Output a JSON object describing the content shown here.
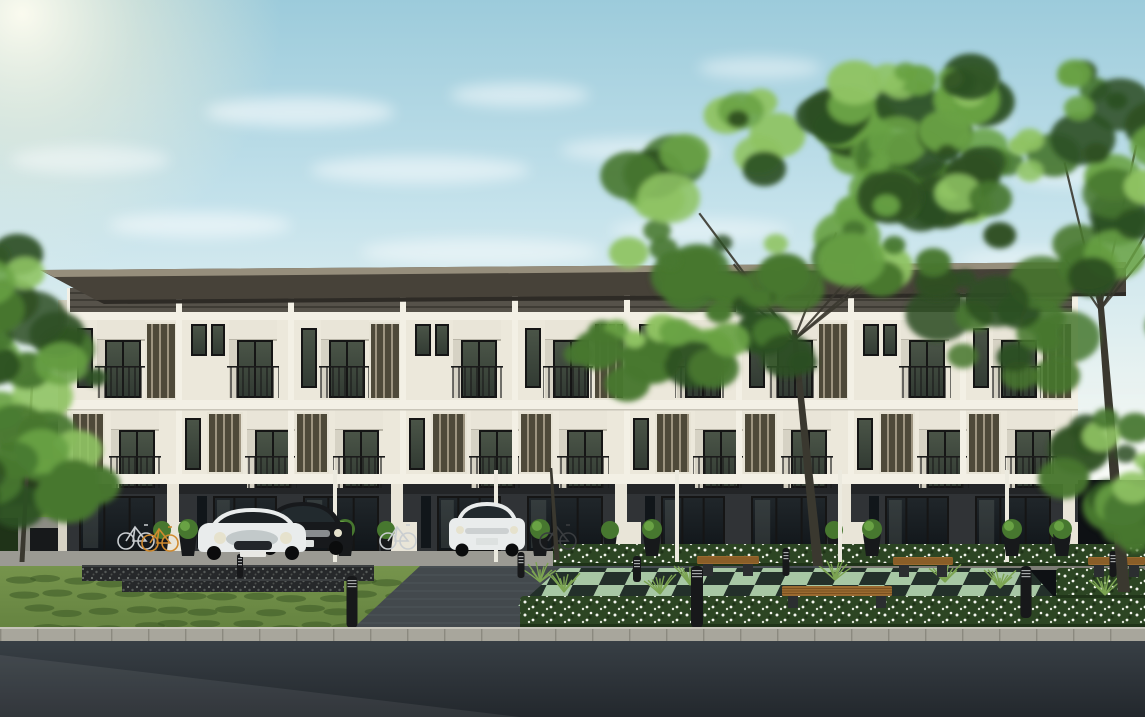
{
  "description": "Architectural rendering of a modern three-storey townhouse row with cream facades, dark vertical louver panels, black-framed balcony glazing, a dark recessed ground floor with parked cars, landscaped front garden with white flower hedges, wooden benches, bollard lights, large green trees and an asphalt road in the foreground under a pale blue sky with a soft sun glow at top left.",
  "palette": {
    "sky_top": "#9ccbdb",
    "sky_mid": "#c6e3ec",
    "sky_low": "#e7f2f1",
    "horizon_haze": "#f2f6ef",
    "sun_core": "#fffdf0",
    "sun_glow": "#f8f3da",
    "cloud": "#ffffff",
    "roof_top": "#968e7c",
    "roof_fascia": "#474239",
    "roof_shadow": "#2e2b26",
    "siding": "#56524a",
    "siding_line": "#3f3c35",
    "mullion": "#f3f0e5",
    "facade": "#ece8db",
    "facade_shade": "#d6d2c4",
    "louver_slat": "#4e4939",
    "louver_gap": "#9d9480",
    "louver_frame": "#e7e3d5",
    "frame": "#151515",
    "glass_top": "#4a5447",
    "glass_bot": "#323b33",
    "glass_dark": "#20262a",
    "glass_dark2": "#11161a",
    "glass_hi": "#9aa89b",
    "rail": "#1b1b1b",
    "ground": "#303336",
    "ground_shadow": "#232527",
    "fin": "#e9e5d8",
    "pavement": "#9b9a93",
    "pavement_dark": "#7e7d76",
    "gabion": "#26282a",
    "gabion_dot": "#6d716f",
    "lawn": "#5f7d3c",
    "lawn_dark": "#3c5926",
    "lawn_light": "#76944c",
    "hedge": "#2c4523",
    "hedge_dark": "#1f3318",
    "flower": "#f3f5ee",
    "grass_spike": "#7ca452",
    "checker_light": "#a7c7a4",
    "checker_dark": "#23302a",
    "driveway": "#43494d",
    "driveway_line": "#51585c",
    "curb": "#a8a69c",
    "curb_line": "#8b897f",
    "road": "#383f45",
    "road_dark": "#23282d",
    "wood": "#9a6a30",
    "wood_dark": "#6f4a1d",
    "bench_base": "#2b2e30",
    "bollard": "#17181a",
    "bollard_ring": "#c9cdcd",
    "pole": "#eceadf",
    "foliage_dark": "#2d4f23",
    "foliage_mid": "#47772f",
    "foliage_light": "#69a244",
    "foliage_hi": "#8fc363",
    "trunk": "#3a382f",
    "car_white": "#e9ecec",
    "car_white_shade": "#c2c9ca",
    "car_black": "#17191c",
    "car_glass": "#222a2e",
    "chrome": "#b9bec0",
    "headlight": "#e6e2cd",
    "bike_silver": "#c9cdd0",
    "bike_orange": "#d08a2e",
    "bike_dark": "#3a3d40",
    "wall_gray": "#8d8d85",
    "bin_dark": "#17191b",
    "distant_lawn": "#7ea24e"
  },
  "scene": {
    "sun": {
      "x": 22,
      "y": 14,
      "r": 260
    },
    "clouds": [
      {
        "x": 300,
        "y": 112,
        "rx": 95,
        "ry": 15,
        "o": 0.55
      },
      {
        "x": 520,
        "y": 95,
        "rx": 70,
        "ry": 12,
        "o": 0.5
      },
      {
        "x": 760,
        "y": 68,
        "rx": 62,
        "ry": 11,
        "o": 0.45
      },
      {
        "x": 930,
        "y": 120,
        "rx": 82,
        "ry": 13,
        "o": 0.4
      },
      {
        "x": 1080,
        "y": 175,
        "rx": 70,
        "ry": 12,
        "o": 0.45
      },
      {
        "x": 420,
        "y": 170,
        "rx": 110,
        "ry": 14,
        "o": 0.5
      },
      {
        "x": 640,
        "y": 150,
        "rx": 80,
        "ry": 12,
        "o": 0.45
      },
      {
        "x": 200,
        "y": 225,
        "rx": 92,
        "ry": 13,
        "o": 0.5
      },
      {
        "x": 480,
        "y": 252,
        "rx": 120,
        "ry": 14,
        "o": 0.45
      },
      {
        "x": 700,
        "y": 230,
        "rx": 90,
        "ry": 12,
        "o": 0.4
      },
      {
        "x": 320,
        "y": 302,
        "rx": 130,
        "ry": 15,
        "o": 0.5
      },
      {
        "x": 560,
        "y": 332,
        "rx": 150,
        "ry": 16,
        "o": 0.45
      },
      {
        "x": 820,
        "y": 300,
        "rx": 110,
        "ry": 13,
        "o": 0.35
      },
      {
        "x": 180,
        "y": 382,
        "rx": 140,
        "ry": 16,
        "o": 0.4
      },
      {
        "x": 480,
        "y": 420,
        "rx": 170,
        "ry": 18,
        "o": 0.4
      },
      {
        "x": 900,
        "y": 400,
        "rx": 120,
        "ry": 14,
        "o": 0.3
      },
      {
        "x": 1050,
        "y": 260,
        "rx": 90,
        "ry": 12,
        "o": 0.35
      },
      {
        "x": 90,
        "y": 160,
        "rx": 80,
        "ry": 14,
        "o": 0.45
      }
    ],
    "building": {
      "left": 67,
      "right": 1078,
      "unit_w": 224,
      "units": 5,
      "roof": {
        "x1": 40,
        "x2": 1126,
        "top": 262
      },
      "clerestory_top": 288,
      "beam1": 312,
      "f3_top": 320,
      "beam2": 400,
      "f2_top": 410,
      "beam3": 474,
      "ground_top": 484,
      "base": 556
    },
    "trunks": [
      {
        "x1": 22,
        "y1": 562,
        "x2": 32,
        "y2": 386,
        "w": 5
      },
      {
        "x1": 557,
        "y1": 560,
        "x2": 551,
        "y2": 468,
        "w": 5
      },
      {
        "x1": 818,
        "y1": 566,
        "x2": 794,
        "y2": 330,
        "w": 10
      },
      {
        "x1": 1124,
        "y1": 592,
        "x2": 1100,
        "y2": 296,
        "w": 12
      }
    ],
    "foliage_clusters": [
      {
        "cx": 25,
        "cy": 430,
        "rx": 82,
        "ry": 118,
        "n": 32,
        "seed": 11
      },
      {
        "cx": 10,
        "cy": 295,
        "rx": 46,
        "ry": 52,
        "n": 10,
        "seed": 5
      },
      {
        "cx": 800,
        "cy": 235,
        "rx": 190,
        "ry": 148,
        "n": 58,
        "seed": 7
      },
      {
        "cx": 660,
        "cy": 330,
        "rx": 92,
        "ry": 80,
        "n": 20,
        "seed": 19
      },
      {
        "cx": 930,
        "cy": 140,
        "rx": 120,
        "ry": 82,
        "n": 26,
        "seed": 9
      },
      {
        "cx": 1040,
        "cy": 220,
        "rx": 172,
        "ry": 182,
        "n": 64,
        "seed": 23
      },
      {
        "cx": 1118,
        "cy": 485,
        "rx": 62,
        "ry": 75,
        "n": 20,
        "seed": 15
      }
    ],
    "cars": [
      {
        "type": "sedan-black",
        "x": 254,
        "y": 500
      },
      {
        "type": "mini-white",
        "x": 198,
        "y": 505
      },
      {
        "type": "suv-white",
        "x": 449,
        "y": 498
      }
    ],
    "bikes": [
      {
        "x": 126,
        "y": 525,
        "c": "bike_silver"
      },
      {
        "x": 150,
        "y": 527,
        "c": "bike_orange"
      },
      {
        "x": 388,
        "y": 525,
        "c": "bike_silver"
      },
      {
        "x": 548,
        "y": 525,
        "c": "bike_dark"
      }
    ],
    "bollards": [
      {
        "x": 352,
        "y": 576,
        "h": 52,
        "w": 11
      },
      {
        "x": 697,
        "y": 566,
        "h": 62,
        "w": 12
      },
      {
        "x": 1026,
        "y": 566,
        "h": 52,
        "w": 11
      },
      {
        "x": 637,
        "y": 556,
        "h": 26,
        "w": 8
      },
      {
        "x": 521,
        "y": 552,
        "h": 26,
        "w": 7
      },
      {
        "x": 786,
        "y": 548,
        "h": 28,
        "w": 7
      },
      {
        "x": 240,
        "y": 554,
        "h": 24,
        "w": 6
      },
      {
        "x": 1113,
        "y": 551,
        "h": 26,
        "w": 7
      }
    ],
    "benches": [
      {
        "x": 697,
        "y": 556,
        "w": 62,
        "h": 8
      },
      {
        "x": 893,
        "y": 557,
        "w": 60,
        "h": 8
      },
      {
        "x": 1088,
        "y": 557,
        "w": 57,
        "h": 8
      },
      {
        "x": 782,
        "y": 586,
        "w": 110,
        "h": 10
      }
    ],
    "poles": [
      333,
      494,
      675,
      838,
      1005
    ],
    "planters": [
      {
        "x": 188,
        "y": 548
      },
      {
        "x": 345,
        "y": 548
      },
      {
        "x": 540,
        "y": 548
      },
      {
        "x": 652,
        "y": 548
      },
      {
        "x": 872,
        "y": 548
      },
      {
        "x": 1012,
        "y": 548
      },
      {
        "x": 1062,
        "y": 548
      }
    ],
    "flower_hedges": [
      {
        "x": 553,
        "y": 544,
        "w": 592,
        "h": 22
      },
      {
        "x": 520,
        "y": 596,
        "w": 625,
        "h": 31
      },
      {
        "x": 1056,
        "y": 568,
        "w": 89,
        "h": 30
      }
    ],
    "grass_clusters": [
      {
        "x": 540,
        "y": 574
      },
      {
        "x": 564,
        "y": 584
      },
      {
        "x": 690,
        "y": 577
      },
      {
        "x": 945,
        "y": 574
      },
      {
        "x": 1000,
        "y": 580
      },
      {
        "x": 1105,
        "y": 587
      },
      {
        "x": 660,
        "y": 586
      },
      {
        "x": 835,
        "y": 572
      }
    ],
    "gabion_walls": [
      {
        "x": 82,
        "y": 565,
        "w": 292,
        "h": 16
      },
      {
        "x": 122,
        "y": 579,
        "w": 222,
        "h": 13
      }
    ],
    "checker": {
      "points": "560,568 1028,568 1062,606 518,606"
    },
    "driveway": {
      "points": "420,566 838,566 934,650 330,650"
    },
    "lawn": {
      "points": "0,566 432,566 472,652 0,652"
    }
  }
}
